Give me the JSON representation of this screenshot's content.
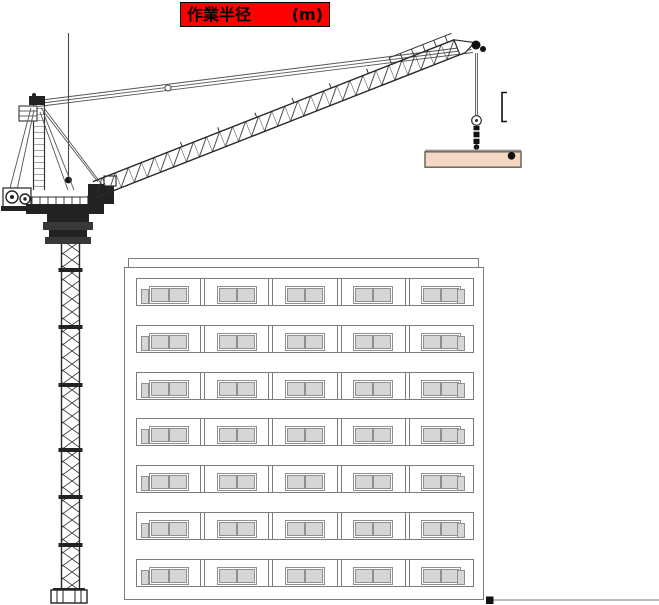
{
  "annotation": {
    "title": "作業半径",
    "unit": "(m)",
    "bg_color": "#ff0000",
    "text_color": "#000000",
    "border_color": "#000000"
  },
  "building": {
    "floors": 7,
    "units_per_floor": 5,
    "windows_per_unit": 2,
    "side_small_windows": true,
    "line_color": "#7c7c7c",
    "pane_color": "#d6d6d6",
    "pane_border_color": "#8f8f8f"
  },
  "load": {
    "beam_fill": "#f5d7c3",
    "beam_border": "#6e655c"
  },
  "theme": {
    "ink": "#1a1a1a",
    "rope": "#555555",
    "ground": "#b0b0b0"
  }
}
